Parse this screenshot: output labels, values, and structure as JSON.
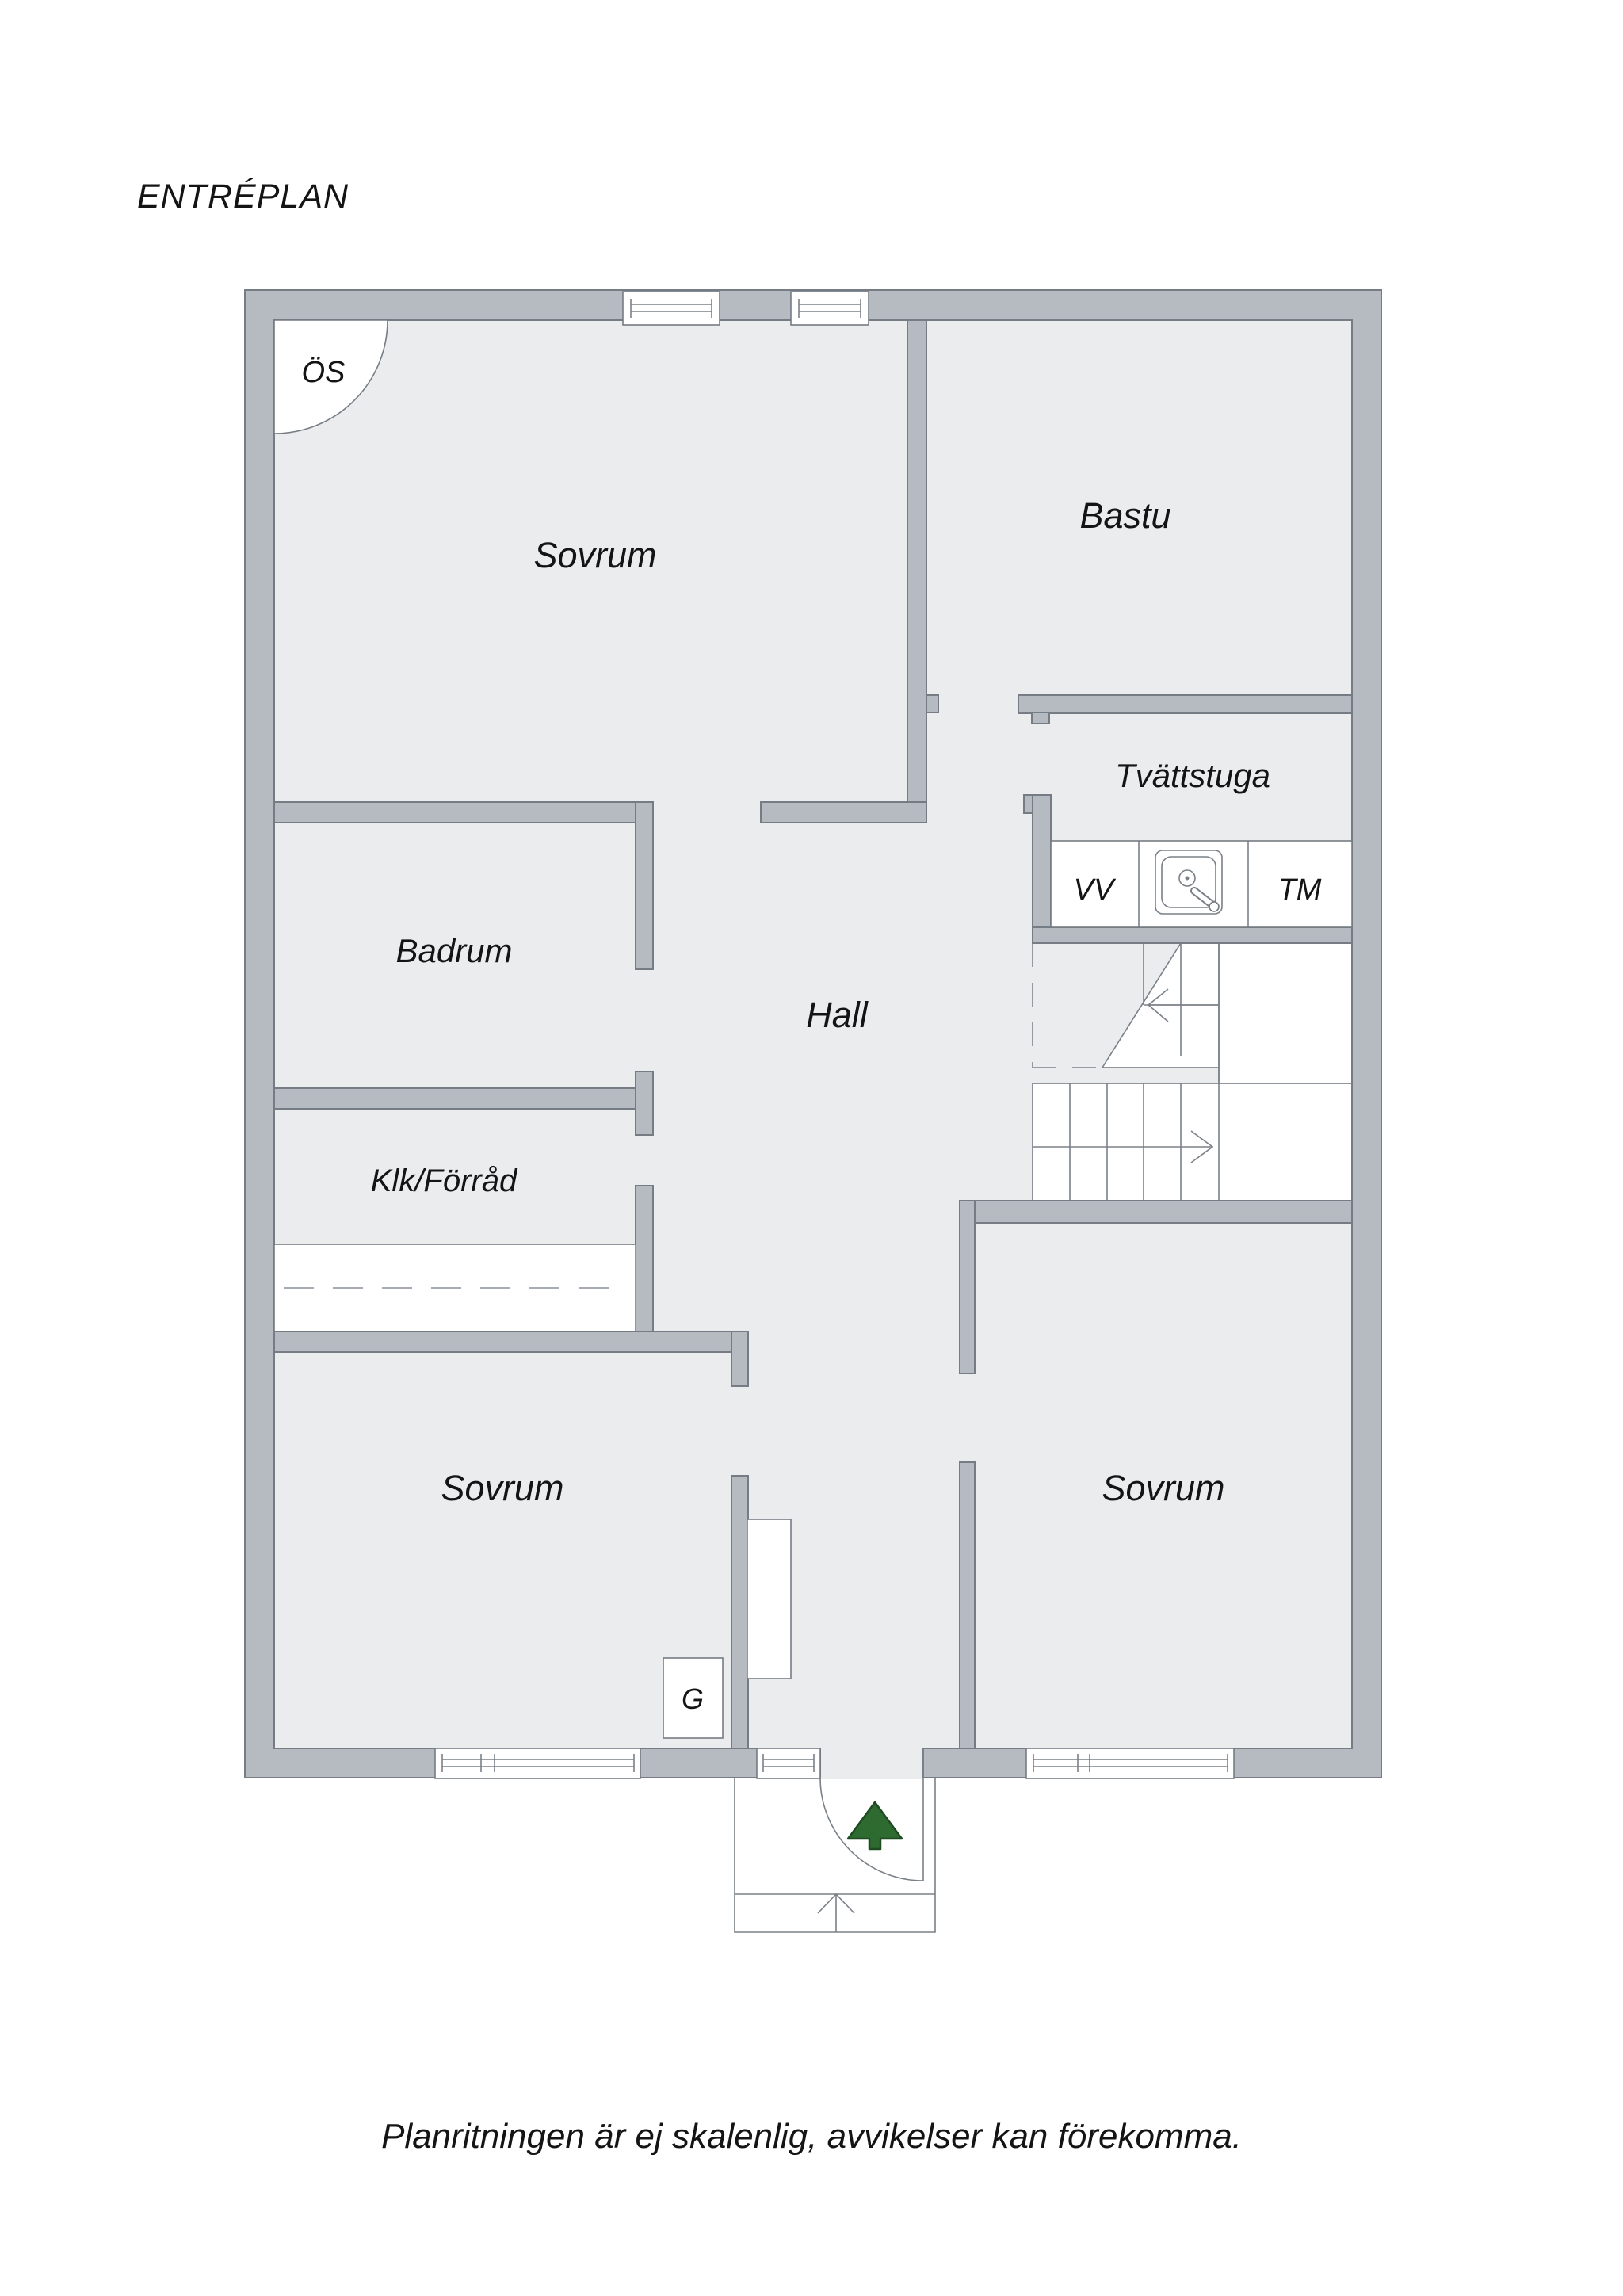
{
  "title": "ENTRÉPLAN",
  "footer": "Planritningen är ej skalenlig, avvikelser kan förekomma.",
  "rooms": [
    {
      "id": "sovrum-top",
      "label": "Sovrum"
    },
    {
      "id": "bastu",
      "label": "Bastu"
    },
    {
      "id": "tvattstuga",
      "label": "Tvättstuga"
    },
    {
      "id": "badrum",
      "label": "Badrum"
    },
    {
      "id": "hall",
      "label": "Hall"
    },
    {
      "id": "klk-forrad",
      "label": "Klk/Förråd"
    },
    {
      "id": "sovrum-bottom-left",
      "label": "Sovrum"
    },
    {
      "id": "sovrum-bottom-right",
      "label": "Sovrum"
    }
  ],
  "markers": {
    "open_fireplace": "ÖS",
    "water_heater": "VV",
    "washing_machine": "TM",
    "wardrobe": "G"
  },
  "colors": {
    "background": "#ffffff",
    "wall_fill": "#b5bbc1",
    "wall_outline": "#757c83",
    "floor": "#ebeced",
    "feature_white": "#ffffff",
    "line": "#7a8087",
    "tree_green": "#2e6b30",
    "tree_outline": "#1f4b22",
    "text": "#141414"
  }
}
